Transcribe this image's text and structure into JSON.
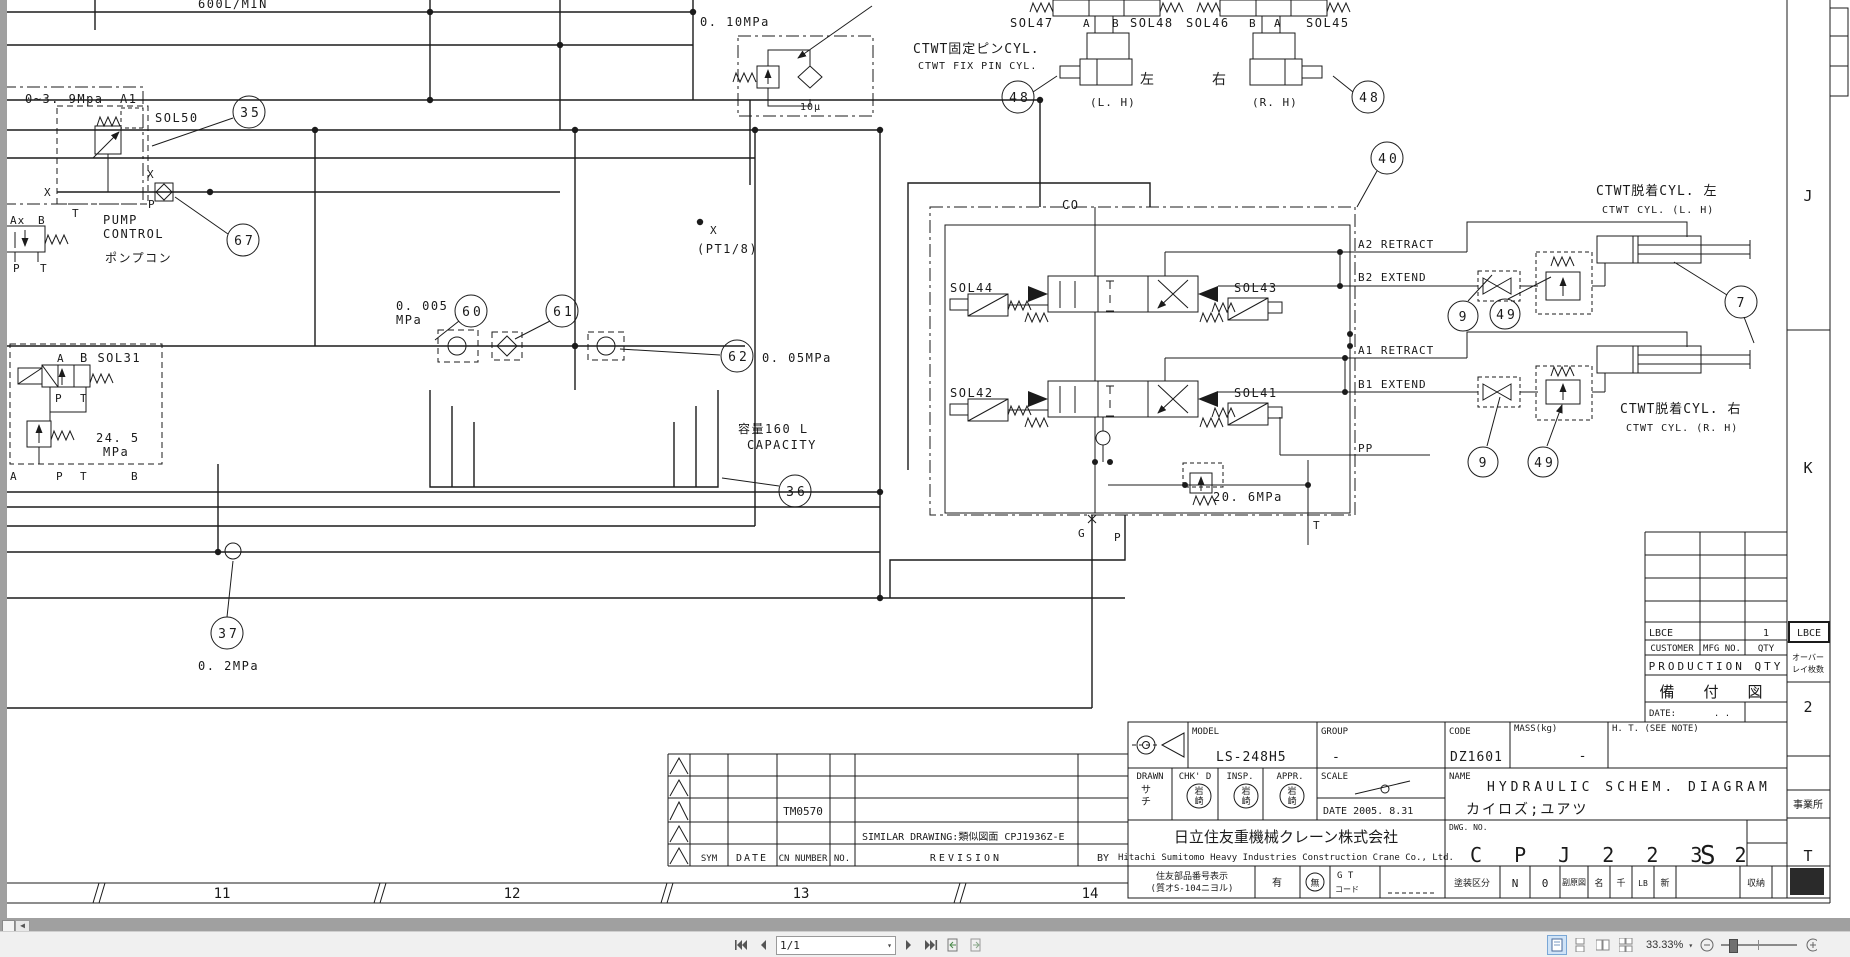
{
  "viewer": {
    "page_indicator": "1/1",
    "zoom_level": "33.33%"
  },
  "schematic": {
    "flow_rate": "600L/MIN",
    "pressure_010": "0. 10MPa",
    "filter_10u": "10μ",
    "pressure_range": "0~3. 9Mpa",
    "port_a1": "A1",
    "sol50": "SOL50",
    "port_x_in": "X",
    "port_x_out": "X",
    "port_p_pump": "P",
    "port_t_pump": "T",
    "pump_control_1": "PUMP",
    "pump_control_2": "CONTROL",
    "pump_control_jp": "ポンプコン",
    "port_ax": "Ax",
    "port_b_left": "B",
    "port_p_left": "P",
    "port_t_left": "T",
    "port_a_sol31": "A",
    "sol31": "B SOL31",
    "port_p_sol31": "P",
    "port_t_sol31": "T",
    "pressure_245_1": "24. 5",
    "pressure_245_2": "MPa",
    "port_a_block": "A",
    "port_p_block": "P",
    "port_t_block": "T",
    "port_b_block": "B",
    "pressure_0005_1": "0. 005",
    "pressure_0005_2": "MPa",
    "port_x_pt": "X",
    "pt_thread": "(PT1/8)",
    "pressure_005": "0. 05MPa",
    "capacity_jp": "容量160 L",
    "capacity_en": "CAPACITY",
    "pressure_02": "0. 2MPa",
    "ctwt_fix_jp": "CTWT固定ピンCYL.",
    "ctwt_fix_en": "CTWT FIX PIN CYL.",
    "sol47": "SOL47",
    "port_a_47": "A",
    "port_b_47": "B",
    "sol48": "SOL48",
    "sol46": "SOL46",
    "port_b_46": "B",
    "port_a_46": "A",
    "sol45": "SOL45",
    "left_jp": "左",
    "left_en": "(L. H)",
    "right_jp": "右",
    "right_en": "(R. H)",
    "co": "CO",
    "sol44": "SOL44",
    "sol43": "SOL43",
    "sol42": "SOL42",
    "sol41": "SOL41",
    "a2_retract": "A2 RETRACT",
    "b2_extend": "B2 EXTEND",
    "a1_retract": "A1 RETRACT",
    "b1_extend": "B1 EXTEND",
    "pp": "PP",
    "port_g": "G",
    "port_p_co": "P",
    "port_t_co": "T",
    "pressure_206": "20. 6MPa",
    "ctwt_cyl_l_jp": "CTWT脱着CYL. 左",
    "ctwt_cyl_l_en": "CTWT CYL. (L. H)",
    "ctwt_cyl_r_jp": "CTWT脱着CYL. 右",
    "ctwt_cyl_r_en": "CTWT CYL. (R. H)",
    "callout_35": "35",
    "callout_67": "67",
    "callout_60": "60",
    "callout_61": "61",
    "callout_62": "62",
    "callout_36": "36",
    "callout_37": "37",
    "callout_40": "40",
    "callout_48": "48",
    "callout_7": "7",
    "callout_9": "9",
    "callout_49": "49",
    "zone_j": "J",
    "zone_k": "K",
    "zone_t": "T",
    "zone_11": "11",
    "zone_12": "12",
    "zone_13": "13",
    "zone_14": "14"
  },
  "production_table": {
    "lbce": "LBCE",
    "lbce_qty": "1",
    "customer": "CUSTOMER",
    "mfg_no": "MFG NO.",
    "qty": "QTY",
    "production_qty": "PRODUCTION QTY",
    "bifuzu": "備 付 図",
    "date_label": "DATE:",
    "date_dots": ".      .",
    "side_lbce": "LBCE",
    "overlay_1": "オーバー",
    "overlay_2": "レイ枚数",
    "overlay_count": "2",
    "office": "事業所"
  },
  "title_block": {
    "model_label": "MODEL",
    "model": "LS-248H5",
    "group_label": "GROUP",
    "group": "-",
    "code_label": "CODE",
    "code": "DZ1601",
    "mass_label": "MASS(kg)",
    "mass": "-",
    "ht_note": "H. T. (SEE NOTE)",
    "drawn": "DRAWN",
    "chkd": "CHK' D",
    "insp": "INSP.",
    "appr": "APPR.",
    "drawn_stamp_1": "サ",
    "drawn_stamp_2": "チ",
    "stamp_top": "岩",
    "stamp_bottom": "崎",
    "scale_label": "SCALE",
    "date": "DATE 2005. 8.31",
    "name_label": "NAME",
    "name_en": "HYDRAULIC SCHEM. DIAGRAM",
    "name_jp": "カイロズ;ユアツ",
    "dwg_label": "DWG. NO.",
    "dwg_no": "C P J 2 2 3 2",
    "dwg_suffix": "S",
    "company_jp": "日立住友重機械クレーン株式会社",
    "company_en": "Hitachi Sumitomo Heavy Industries Construction Crane Co., Ltd."
  },
  "revision_table": {
    "tm": "TM0570",
    "similar": "SIMILAR DRAWING:類似図面 CPJ1936Z-E",
    "sym": "SYM",
    "date": "DATE",
    "cn_number": "CN NUMBER",
    "no": "NO.",
    "revision": "REVISION",
    "by": "BY"
  },
  "parts_row": {
    "label_1": "住友部品番号表示",
    "label_2": "(質オS-104ニヨル)",
    "yes": "有",
    "no": "無",
    "gt_1": "G T",
    "gt_2": "コード",
    "paint_label": "塗装区分",
    "paint_1": "N",
    "paint_2": "0",
    "fukugenzu": "副原図",
    "cell_mei": "名",
    "cell_sen": "千",
    "cell_lb": "LB",
    "cell_shin": "新",
    "shuno": "収納"
  }
}
